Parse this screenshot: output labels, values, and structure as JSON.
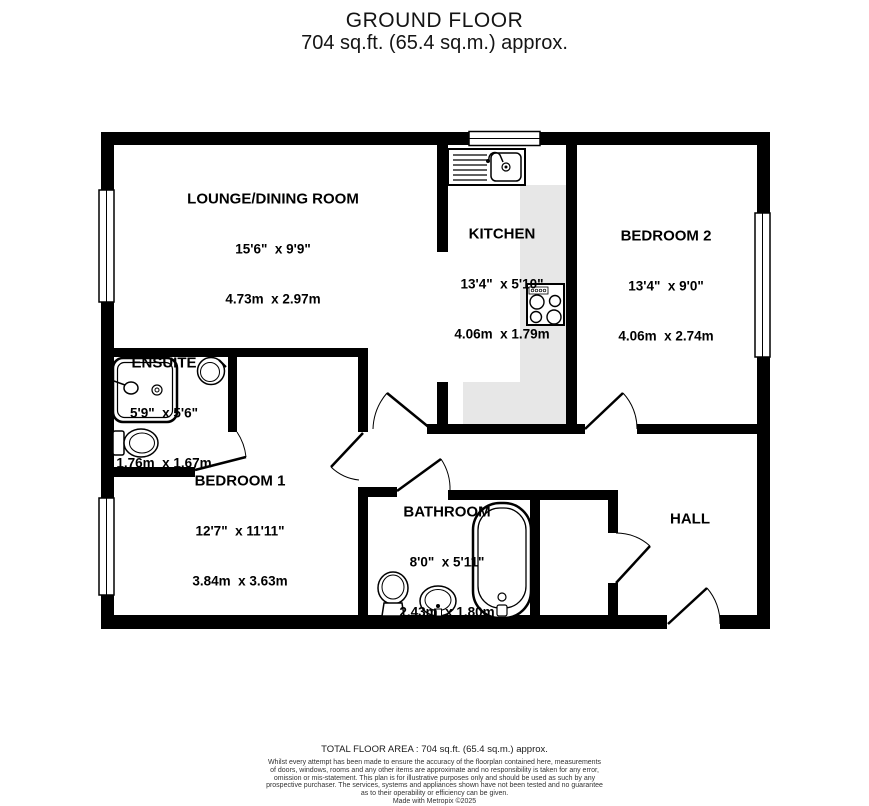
{
  "header": {
    "title": "GROUND FLOOR",
    "subtitle": "704 sq.ft. (65.4 sq.m.) approx."
  },
  "rooms": [
    {
      "name": "LOUNGE/DINING ROOM",
      "imperial": "15'6\"  x 9'9\"",
      "metric": "4.73m  x 2.97m"
    },
    {
      "name": "KITCHEN",
      "imperial": "13'4\"  x 5'10\"",
      "metric": "4.06m  x 1.79m"
    },
    {
      "name": "BEDROOM 2",
      "imperial": "13'4\"  x 9'0\"",
      "metric": "4.06m  x 2.74m"
    },
    {
      "name": "ENSUITE",
      "imperial": "5'9\"  x 5'6\"",
      "metric": "1.76m  x 1.67m"
    },
    {
      "name": "BEDROOM 1",
      "imperial": "12'7\"  x 11'11\"",
      "metric": "3.84m  x 3.63m"
    },
    {
      "name": "BATHROOM",
      "imperial": "8'0\"  x 5'11\"",
      "metric": "2.43m  x 1.80m"
    },
    {
      "name": "HALL"
    }
  ],
  "footer": {
    "total_area": "TOTAL FLOOR AREA : 704 sq.ft. (65.4 sq.m.) approx.",
    "disclaimer_lines": [
      "Whilst every attempt has been made to ensure the accuracy of the floorplan contained here, measurements",
      "of doors, windows, rooms and any other items are approximate and no responsibility is taken for any error,",
      "omission or mis-statement. This plan is for illustrative purposes only and should be used as such by any",
      "prospective purchaser. The services, systems and appliances shown have not been tested and no guarantee",
      "as to their operability or efficiency can be given.",
      "Made with Metropix ©2025"
    ]
  },
  "colors": {
    "wall": "#000000",
    "kitchen_floor": "#e7e7e7",
    "background": "#ffffff"
  }
}
